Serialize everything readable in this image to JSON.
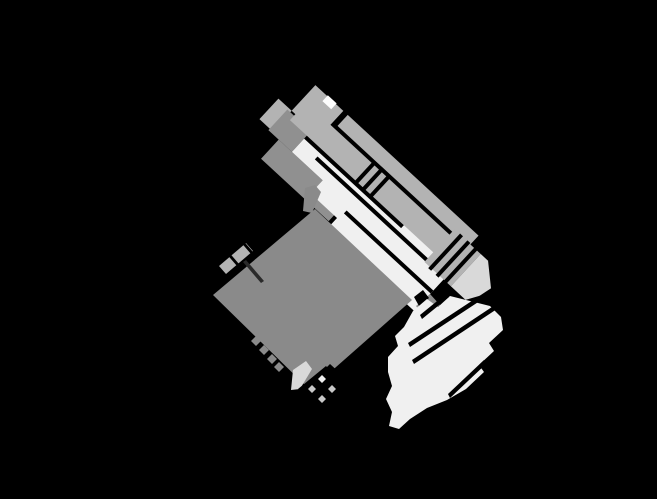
{
  "canvas": {
    "width": 657,
    "height": 499
  },
  "drawing": {
    "description": "Monochrome technical sectional drawing of an angled mechanical assembly on a black background, rotated approximately 47 degrees",
    "rotation_deg": -47.3,
    "parts": [
      {
        "id": "main-housing",
        "label": "main housing block"
      },
      {
        "id": "mounting-screw",
        "label": "mounting screw with cross head"
      },
      {
        "id": "terminal-block",
        "label": "terminal block with grid cells"
      },
      {
        "id": "end-cap",
        "label": "end cap"
      },
      {
        "id": "collet",
        "label": "collet / cap nut"
      },
      {
        "id": "outer-sleeve",
        "label": "outer sleeve band"
      },
      {
        "id": "inner-barrel",
        "label": "inner ribbed barrel"
      },
      {
        "id": "rib-collar-1",
        "label": "upper rib collar"
      },
      {
        "id": "rib-collar-2",
        "label": "lower rib collar"
      },
      {
        "id": "nozzle-tip",
        "label": "tapered tip"
      },
      {
        "id": "white-band",
        "label": "white barrel band"
      },
      {
        "id": "break-section",
        "label": "broken-away section with wavy break line"
      }
    ]
  },
  "colors": {
    "background": "#000000",
    "body": "#8a8a8a",
    "collet": "#909090",
    "silver": "#b3b3b3",
    "white_band": "#f0f0f0",
    "bright_white": "#fcfcfc",
    "tip": "#d9d9d9",
    "wedge": "#d9d9d9",
    "cell": "#c8c8c8",
    "cell_highlight": "#f0f0f0",
    "stem_dark": "#2a2a2a",
    "outline": "#000000"
  }
}
